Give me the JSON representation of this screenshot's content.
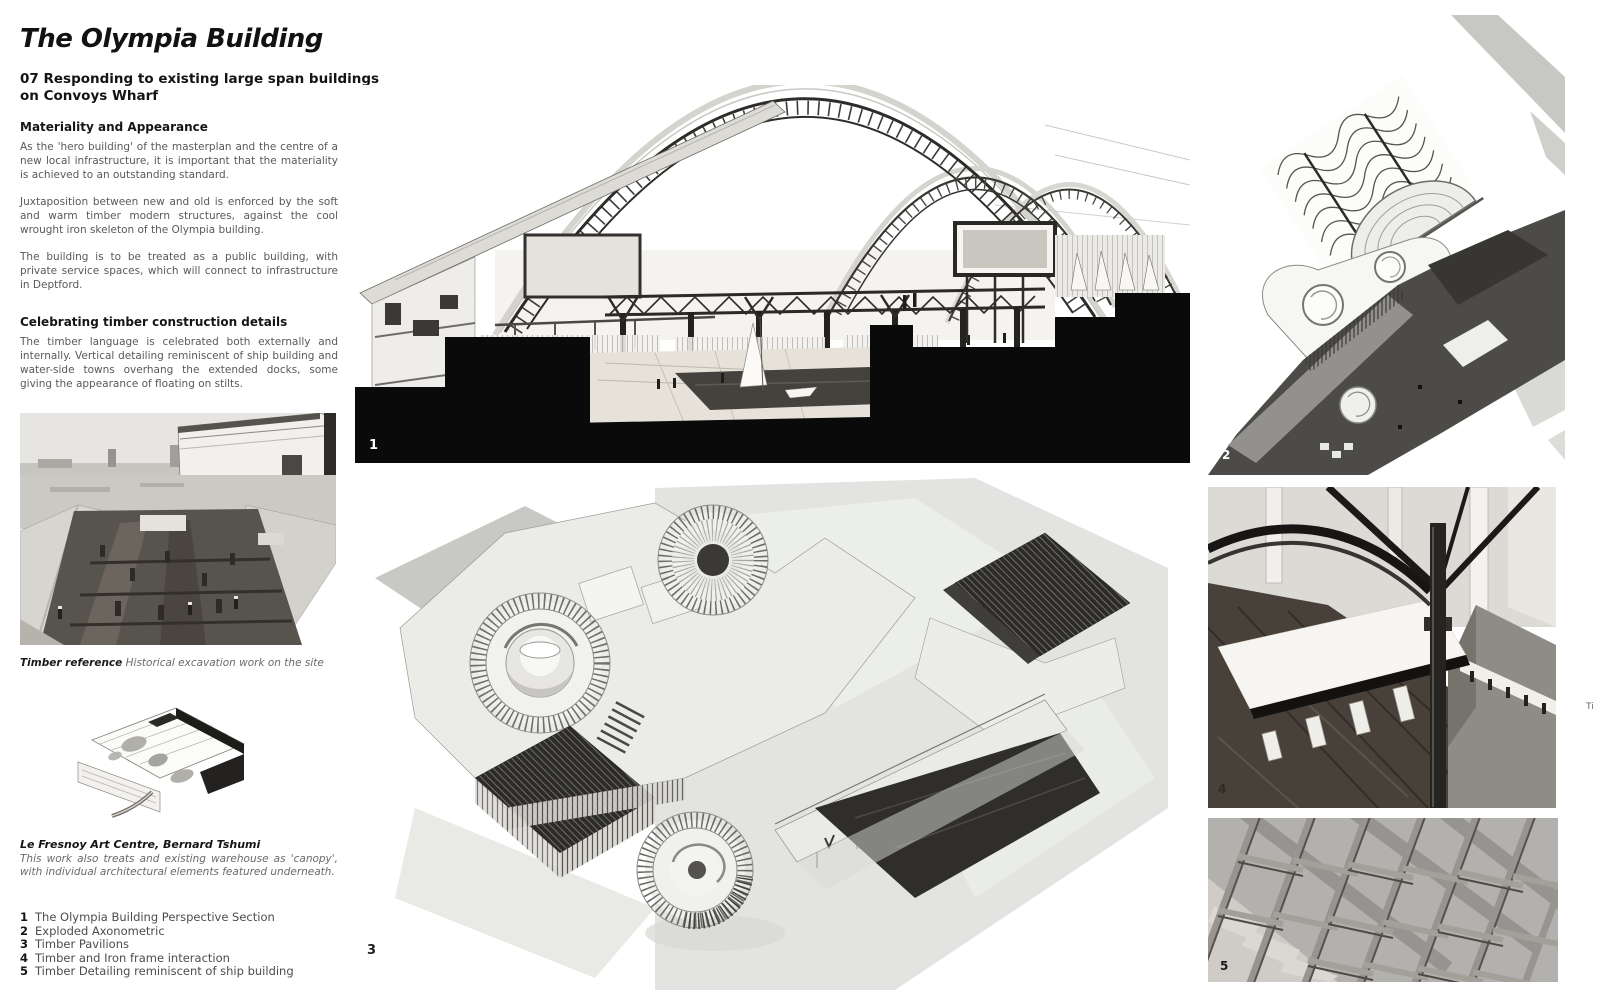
{
  "page": {
    "title": "The Olympia Building",
    "subtitle_lines": [
      "07 Responding to existing large span buildings",
      "on Convoys Wharf"
    ]
  },
  "sections": {
    "materiality": {
      "heading": "Materiality and Appearance",
      "para1": "As the 'hero building' of the masterplan and the centre of a new local infrastructure, it is important that the materiality is achieved to an outstanding standard.",
      "para2": "Juxtaposition between new and old is enforced by the soft and warm timber modern structures, against the cool wrought iron skeleton of the Olympia building.",
      "para3": "The building is to be treated as a public building, with private service spaces, which will connect to infrastructure in Deptford."
    },
    "timber": {
      "heading": "Celebrating timber construction details",
      "para1": "The timber language is celebrated both externally and internally. Vertical detailing reminiscent of ship building and water-side towns overhang the extended docks, some giving the appearance of floating on stilts."
    }
  },
  "captions": {
    "timber_reference": {
      "lead": "Timber reference",
      "rest": " Historical excavation work on the site"
    },
    "fresnoy": {
      "lead": "Le Fresnoy Art Centre, Bernard Tshumi",
      "rest": "This work also treats and existing warehouse as 'canopy', with individual architectural elements featured underneath."
    }
  },
  "legend": {
    "items": [
      {
        "num": "1",
        "label": "The Olympia Building Perspective Section"
      },
      {
        "num": "2",
        "label": "Exploded Axonometric"
      },
      {
        "num": "3",
        "label": "Timber Pavilions"
      },
      {
        "num": "4",
        "label": "Timber and Iron frame interaction"
      },
      {
        "num": "5",
        "label": "Timber Detailing reminiscent of ship building"
      }
    ]
  },
  "figures": {
    "f1": {
      "number": "1"
    },
    "f2": {
      "number": "2"
    },
    "f3": {
      "number": "3"
    },
    "f4": {
      "number": "4"
    },
    "f5": {
      "number": "5"
    },
    "edge_fragment": "Ti"
  },
  "colors": {
    "ink": "#121212",
    "body_text": "#595959",
    "section_cut_black": "#0a0a0a",
    "wash_grey": "#e3e4e1"
  }
}
